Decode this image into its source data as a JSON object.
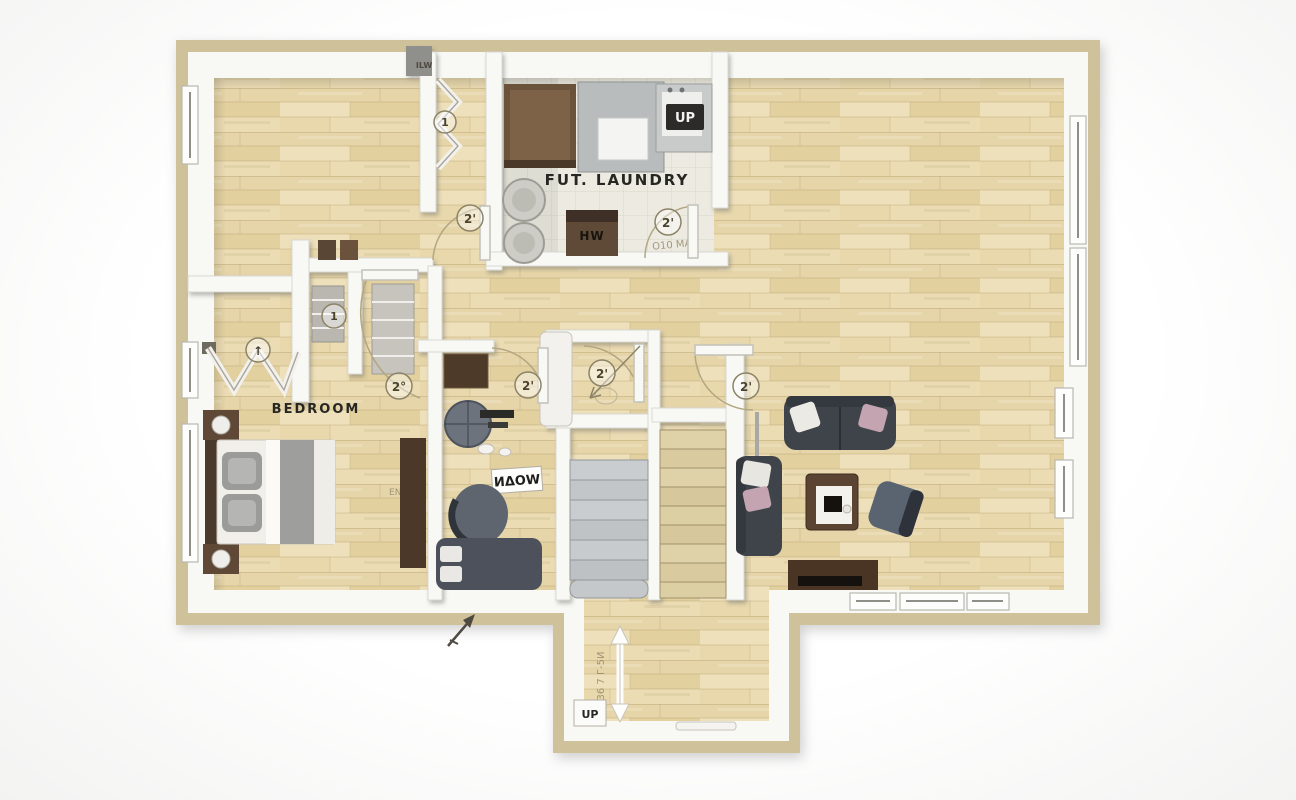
{
  "palette": {
    "outer_band": "#cfc199",
    "wall_white": "#f8f8f5",
    "wood_floor": "#e9dab0",
    "tile_floor": "#edebe1",
    "dark_furniture": "#3f444b",
    "brown_furniture": "#5c4432",
    "stair_gray": "#c4c8ca"
  },
  "labels": {
    "laundry_room": "FUT. LAUNDRY",
    "bedroom": "BEDROOM",
    "den_sign": "ИΔOW",
    "laundry_unit_chip": "UP",
    "laundry_cabinet": "HW",
    "laundry_door_note": "O10 MA",
    "bedroom_note": "ENT",
    "entry_dimension": "36 7 Г-5И",
    "entry_chip": "UP",
    "wall_note": "ILW"
  },
  "door_tags": {
    "laundry": "2'",
    "hallway": "2'",
    "bedroom": "2°",
    "den": "2'",
    "bath": "2'",
    "stair_hall": "2'",
    "closet": "1",
    "hall_closet": "1",
    "bifold": "↑"
  }
}
